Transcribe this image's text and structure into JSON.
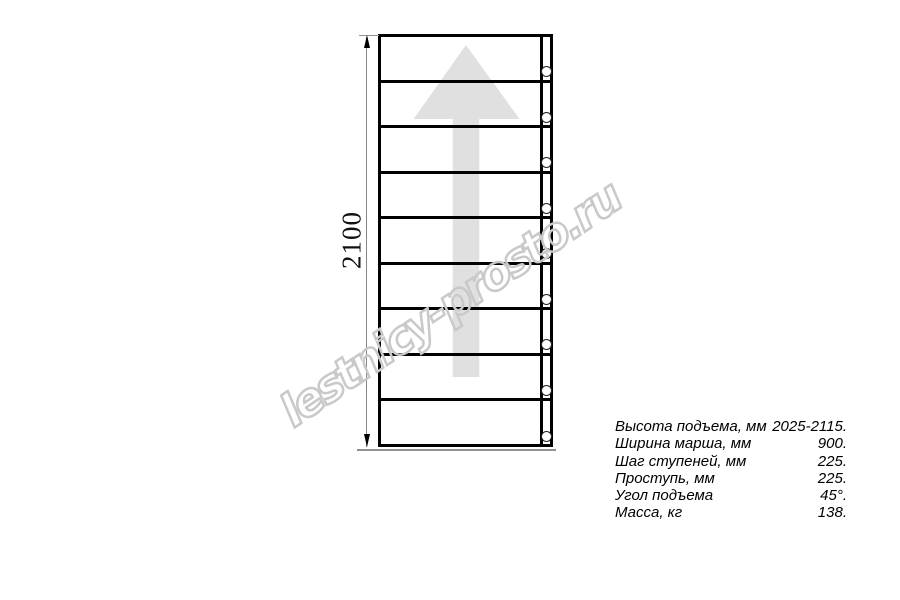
{
  "drawing": {
    "dimension_label": "2100",
    "treads_count": 9,
    "direction_arrow": "up"
  },
  "watermark": {
    "text": "lestnicy-prosto.ru"
  },
  "specs": {
    "rows": [
      {
        "label": "Высота подъема, мм",
        "value": "2025-2115."
      },
      {
        "label": "Ширина марша, мм",
        "value": "900."
      },
      {
        "label": "Шаг ступеней, мм",
        "value": "225."
      },
      {
        "label": "Проступь, мм",
        "value": "225."
      },
      {
        "label": "Угол подъема",
        "value": "45°."
      },
      {
        "label": "Масса, кг",
        "value": "138."
      }
    ]
  },
  "colors": {
    "line": "#000000",
    "dimension": "#878787",
    "arrow_fill": "#e0e0e0",
    "watermark_outline": "#c9c9c9"
  }
}
